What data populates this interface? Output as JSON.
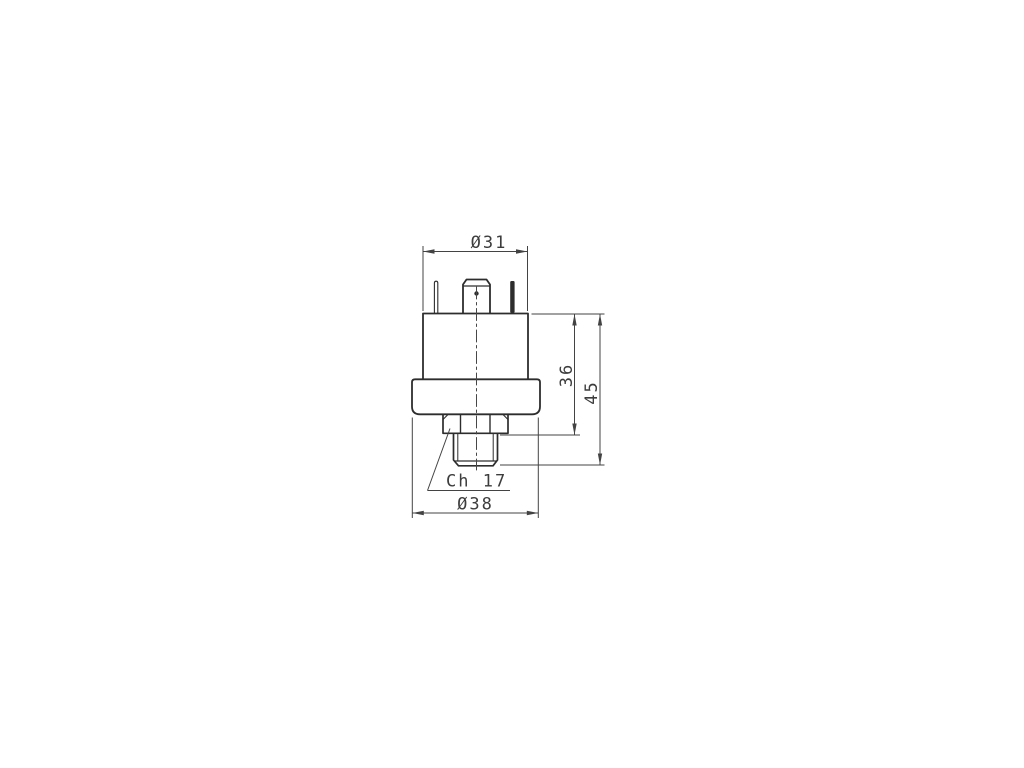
{
  "document": {
    "background_color": "#ffffff",
    "kind": "technical-dimension-drawing",
    "subject": "pressure-switch-front-view"
  },
  "drawing": {
    "object_line_color": "#2d2d2d",
    "dimension_line_color": "#434343",
    "text_color": "#3d3d3d",
    "labels": {
      "top_diameter": "Ø31",
      "upper_height": "36",
      "total_height": "45",
      "wrench_size": "Ch 17",
      "flange_diameter": "Ø38"
    }
  }
}
